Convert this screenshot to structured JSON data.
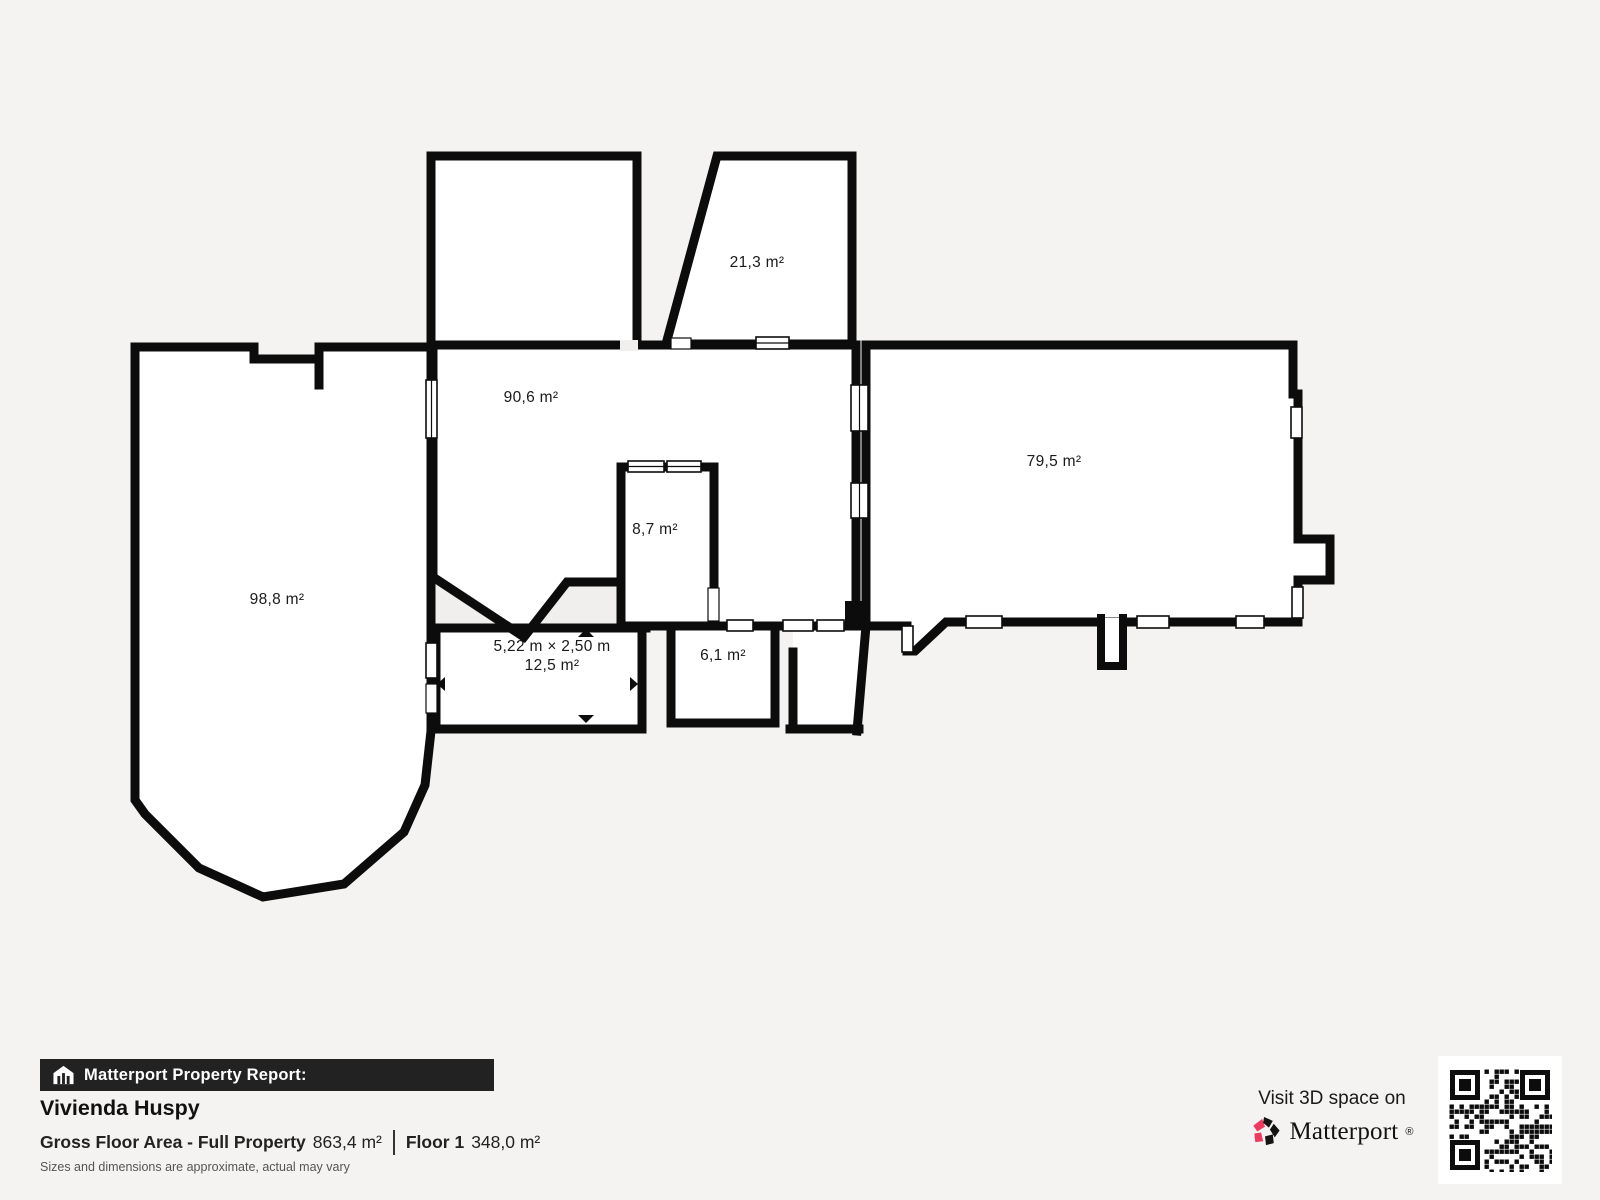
{
  "plan": {
    "rooms": [
      {
        "name": "room-21",
        "area": "21,3 m²"
      },
      {
        "name": "room-90",
        "area": "90,6 m²"
      },
      {
        "name": "room-98",
        "area": "98,8 m²"
      },
      {
        "name": "room-8",
        "area": "8,7 m²"
      },
      {
        "name": "room-79",
        "area": "79,5 m²"
      },
      {
        "name": "room-6",
        "area": "6,1 m²"
      },
      {
        "name": "room-12",
        "area": "12,5 m²",
        "dimensions": "5,22 m × 2,50 m"
      }
    ]
  },
  "report": {
    "banner_label": "Matterport Property Report:",
    "property_name": "Vivienda Huspy",
    "gross_floor_area_label": "Gross Floor Area - Full Property",
    "gross_floor_area_value": "863,4 m²",
    "floor_label": "Floor 1",
    "floor_value": "348,0 m²",
    "disclaimer": "Sizes and dimensions are approximate, actual may vary"
  },
  "cta": {
    "visit_label": "Visit 3D space on",
    "brand_name": "Matterport",
    "trademark": "®"
  },
  "colors": {
    "background": "#f4f3f1",
    "wall": "#0c0c0c",
    "banner_bg": "#222222",
    "brand_pink": "#ee3a5f",
    "text_dark": "#1a1a1a",
    "muted_text": "#555555"
  }
}
